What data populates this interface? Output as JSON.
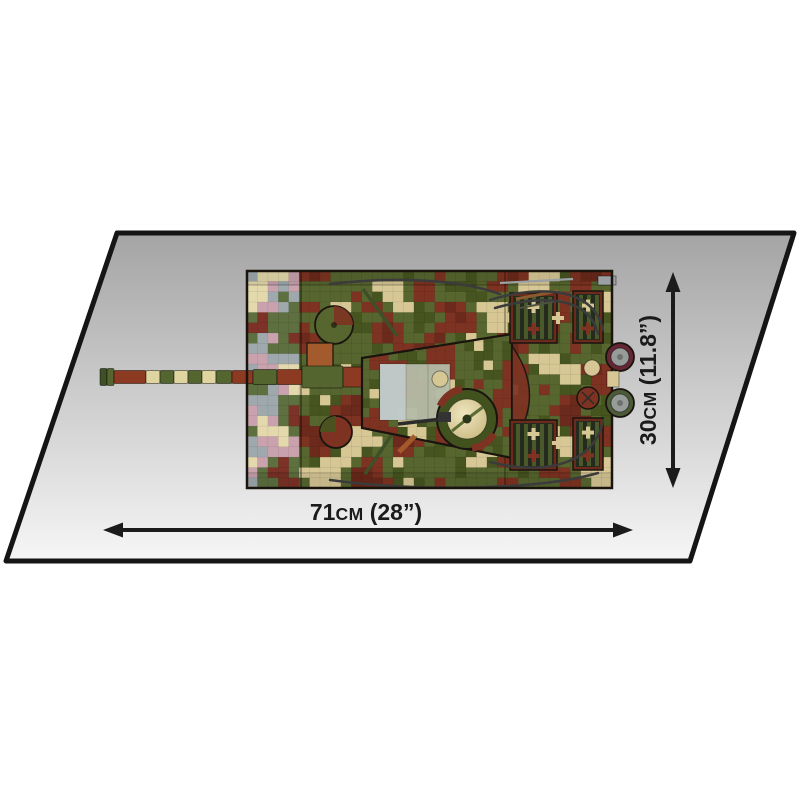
{
  "page": {
    "background": "#ffffff"
  },
  "surface": {
    "gradient_top": "#a4a4a4",
    "gradient_mid": "#cdcdcd",
    "gradient_bottom": "#f6f6f6",
    "border_color": "#151515"
  },
  "dimensions": {
    "width": {
      "value": "71",
      "unit": "cm",
      "imperial": "(28”)"
    },
    "height": {
      "value": "30",
      "unit": "cm",
      "imperial": "(11.8”)"
    },
    "arrow_color": "#1b1b1b",
    "label_color": "#1b1b1b"
  },
  "model": {
    "name": "tank-top-view",
    "outline": "#1a140f",
    "camo_palette": {
      "green": "#57662f",
      "green_dark": "#46541f",
      "brown": "#7e3322",
      "brown_dark": "#6b2a1c",
      "tan": "#d6c795"
    },
    "front_palette": {
      "pink": "#c9a2ae",
      "gray": "#9fa9ad",
      "cream": "#e4d9ac",
      "green": "#5e7040",
      "brown": "#7c3227"
    },
    "barrel": {
      "red": "#8c3a22",
      "green": "#55652f",
      "cream": "#e0d5a0",
      "muzzle": "#3f4f26"
    },
    "details": {
      "roof": "#b6bca8",
      "roof_light": "#c2cdd1",
      "dome_center": "#efe6c0",
      "dome_edge": "#c9b97f",
      "cable": "#3b3b3b",
      "grille_slat": "#4a592c",
      "grille_bg": "#242a1c",
      "exhaust_gray": "#979c98",
      "exhaust_red_housing": "#642734",
      "exhaust_green_housing": "#4c5a38",
      "crate": "#a35a2c"
    }
  }
}
